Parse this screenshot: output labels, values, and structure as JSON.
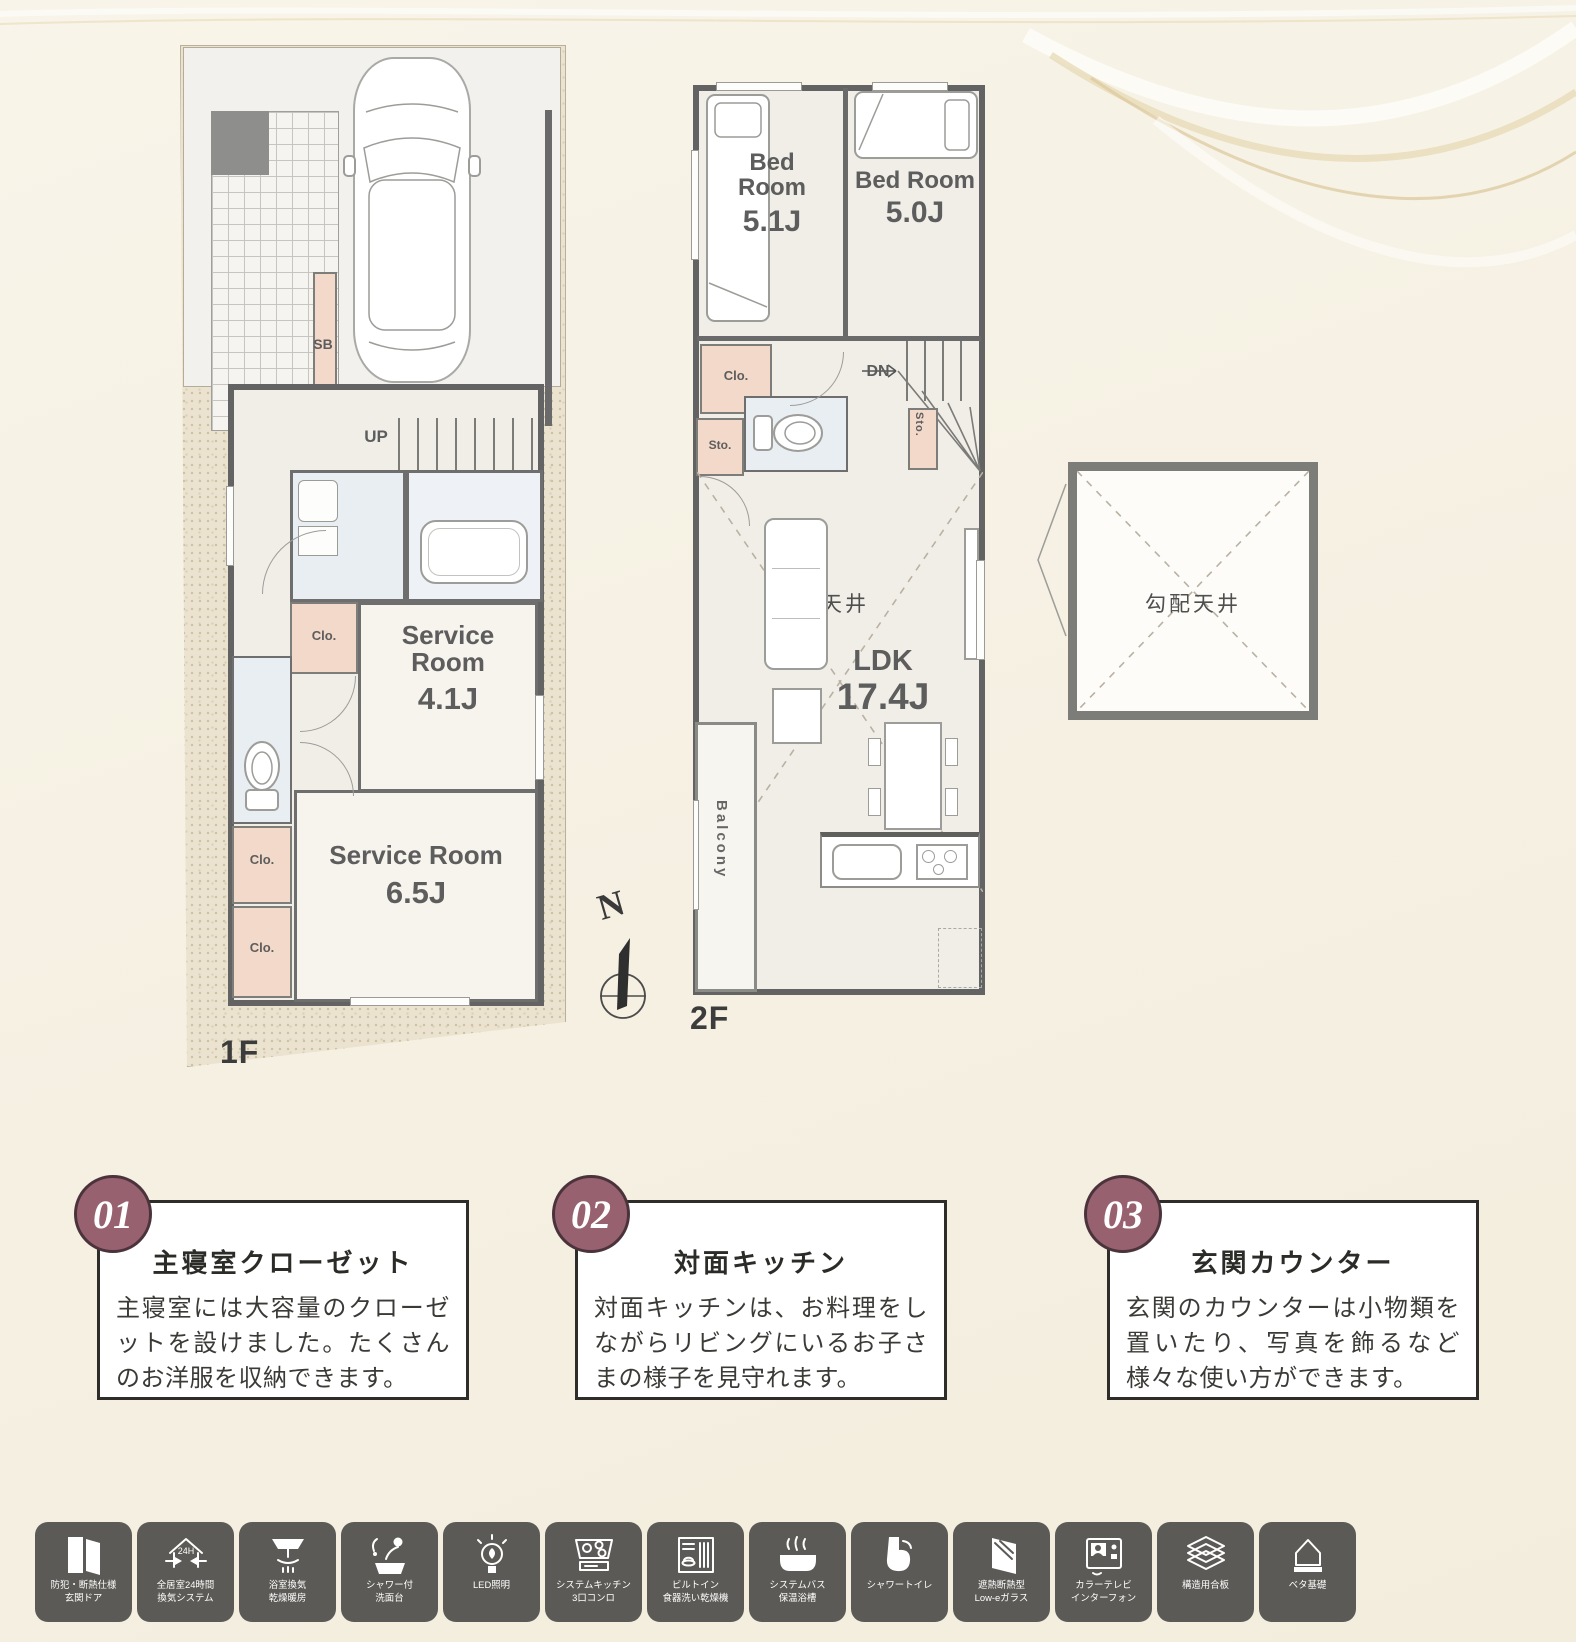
{
  "colors": {
    "background": "#f5f0e2",
    "accent_circle": "#976170",
    "equipment_tile": "#5b5a56",
    "wall": "#636363",
    "closet_pink": "#f3d9ca",
    "plumbing_blue": "#e9eef3",
    "site_beige": "#ebe3cf"
  },
  "floor1": {
    "label": "1F",
    "up_label": "UP",
    "sb_label": "SB",
    "closet1_label": "Clo.",
    "closet2_label": "Clo.",
    "closet3_label": "Clo.",
    "service_small": {
      "line1": "Service",
      "line2": "Room",
      "size": "4.1J"
    },
    "service_large": {
      "name": "Service Room",
      "size": "6.5J"
    }
  },
  "floor2": {
    "label": "2F",
    "dn_label": "DN",
    "bedroom1": {
      "line1": "Bed",
      "line2": "Room",
      "size": "5.1J"
    },
    "bedroom2": {
      "name": "Bed Room",
      "size": "5.0J"
    },
    "closet_label": "Clo.",
    "storage1_label": "Sto.",
    "storage2_label": "Sto.",
    "sloped_ceiling_label": "勾配天井",
    "ldk": {
      "name": "LDK",
      "size": "17.4J"
    },
    "balcony_label": "Balcony"
  },
  "loft": {
    "sloped_ceiling_label": "勾配天井"
  },
  "compass": {
    "north_label": "N"
  },
  "features": [
    {
      "number": "01",
      "title": "主寝室クローゼット",
      "body": "主寝室には大容量のクローゼットを設けました。たくさんのお洋服を収納できます。"
    },
    {
      "number": "02",
      "title": "対面キッチン",
      "body": "対面キッチンは、お料理をしながらリビングにいるお子さまの様子を見守れます。"
    },
    {
      "number": "03",
      "title": "玄関カウンター",
      "body": "玄関のカウンターは小物類を置いたり、写真を飾るなど様々な使い方ができます。"
    }
  ],
  "equipment": [
    {
      "icon": "security-door-icon",
      "label1": "防犯・断熱仕様",
      "label2": "玄関ドア"
    },
    {
      "icon": "ventilation-24h-icon",
      "badge": "24H",
      "label1": "全居室24時間",
      "label2": "換気システム"
    },
    {
      "icon": "bath-dryer-icon",
      "label1": "浴室換気",
      "label2": "乾燥暖房"
    },
    {
      "icon": "shower-vanity-icon",
      "label1": "シャワー付",
      "label2": "洗面台"
    },
    {
      "icon": "led-light-icon",
      "label1": "LED照明",
      "label2": ""
    },
    {
      "icon": "system-kitchen-icon",
      "label1": "システムキッチン",
      "label2": "3口コンロ"
    },
    {
      "icon": "dishwasher-icon",
      "label1": "ビルトイン",
      "label2": "食器洗い乾燥機"
    },
    {
      "icon": "insulated-bathtub-icon",
      "label1": "システムバス",
      "label2": "保温浴槽"
    },
    {
      "icon": "shower-toilet-icon",
      "label1": "シャワートイレ",
      "label2": ""
    },
    {
      "icon": "low-e-glass-icon",
      "label1": "遮熱断熱型",
      "label2": "Low-eガラス"
    },
    {
      "icon": "tv-intercom-icon",
      "label1": "カラーテレビ",
      "label2": "インターフォン"
    },
    {
      "icon": "structural-plywood-icon",
      "label1": "構造用合板",
      "label2": ""
    },
    {
      "icon": "slab-foundation-icon",
      "label1": "ベタ基礎",
      "label2": ""
    }
  ]
}
